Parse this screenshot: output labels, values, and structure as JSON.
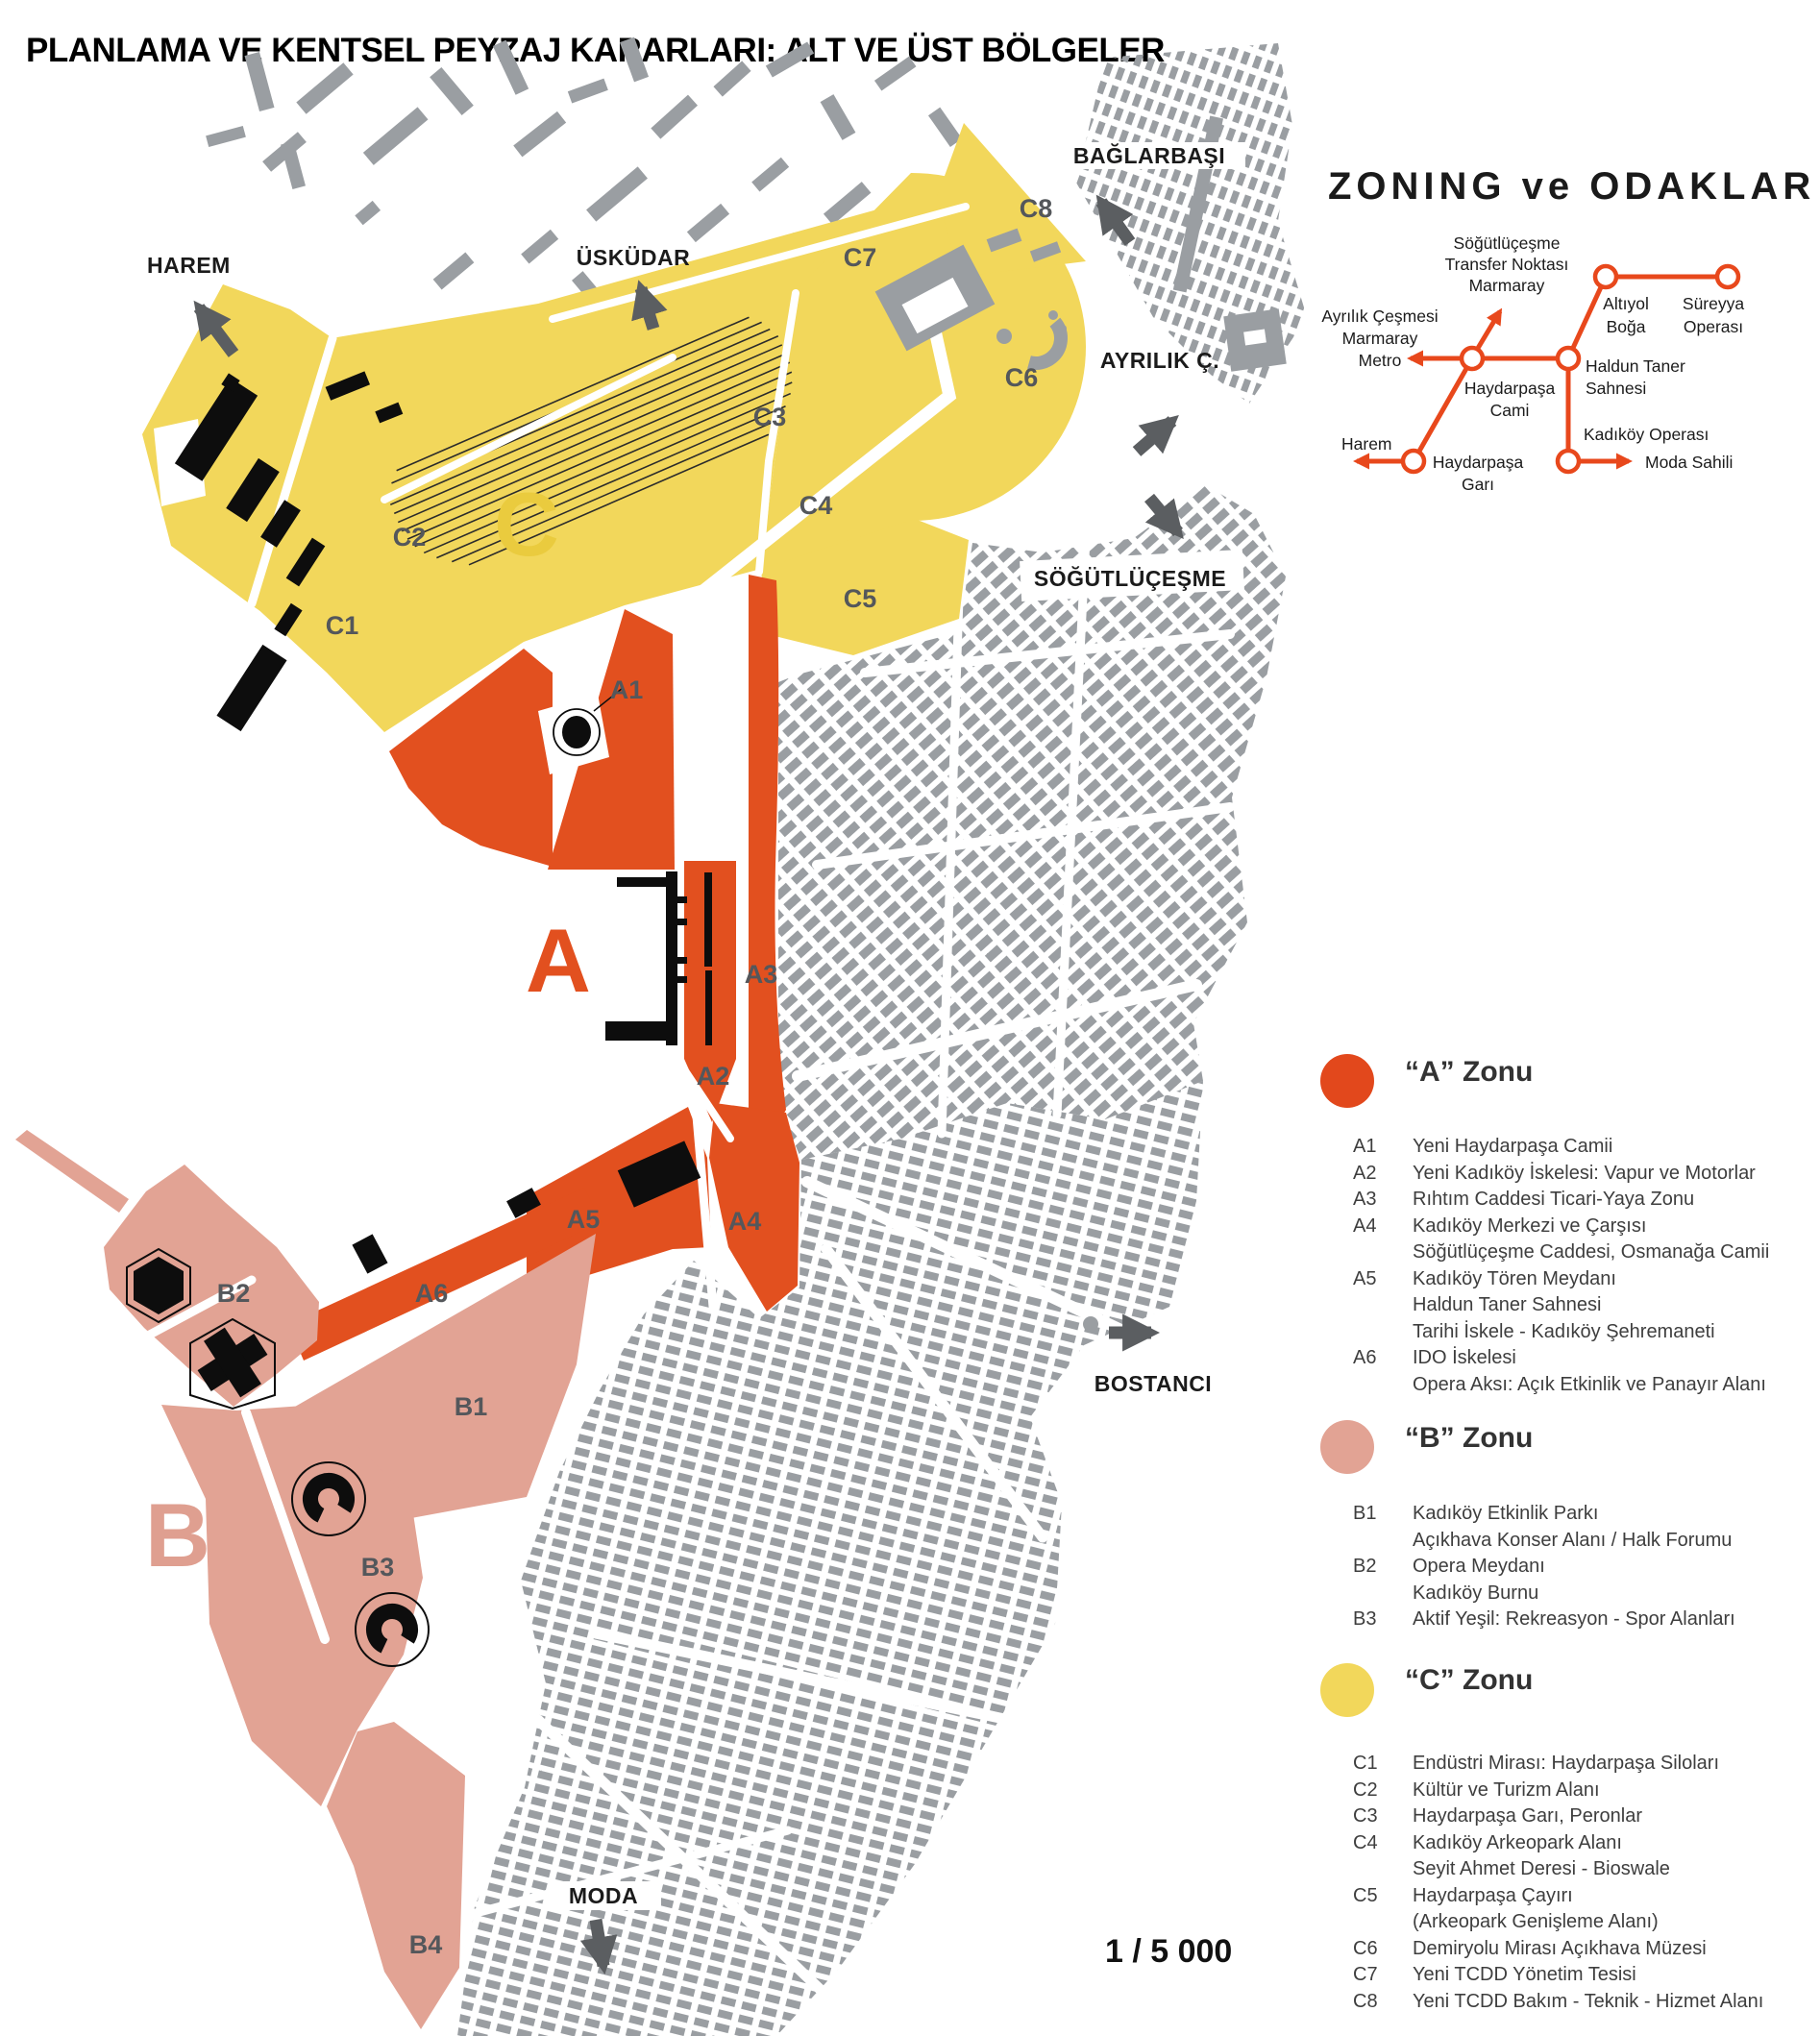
{
  "title": "PLANLAMA VE KENTSEL PEYZAJ KARARLARI: ALT VE ÜST BÖLGELER",
  "map": {
    "scale_label": "1 / 5 000",
    "places": {
      "harem": "HAREM",
      "uskudar": "ÜSKÜDAR",
      "baglarbasi": "BAĞLARBAŞI",
      "ayrilik": "AYRILIK Ç.",
      "sogutlucesme": "SÖĞÜTLÜÇEŞME",
      "bostanci": "BOSTANCI",
      "moda": "MODA"
    },
    "zone_letters": {
      "a": "A",
      "b": "B",
      "c": "C"
    },
    "codes": {
      "a1": "A1",
      "a2": "A2",
      "a3": "A3",
      "a4": "A4",
      "a5": "A5",
      "a6": "A6",
      "b1": "B1",
      "b2": "B2",
      "b3": "B3",
      "b4": "B4",
      "c1": "C1",
      "c2": "C2",
      "c3": "C3",
      "c4": "C4",
      "c5": "C5",
      "c6": "C6",
      "c7": "C7",
      "c8": "C8"
    },
    "colors": {
      "zone_a": "#e2501f",
      "zone_b": "#e2a394",
      "zone_c": "#f2d75b",
      "fabric_gray": "#9a9ea2",
      "arrow_gray": "#5b5e61",
      "building_black": "#0d0d0d"
    }
  },
  "panel": {
    "title": "ZONING ve ODAKLAR",
    "network": {
      "color": "#e8481c",
      "labels": {
        "sogutlucesme": [
          "Söğütlüçeşme",
          "Transfer Noktası",
          "Marmaray"
        ],
        "altiyol": [
          "Altıyol",
          "Boğa"
        ],
        "sureyya": [
          "Süreyya",
          "Operası"
        ],
        "ayrilik": [
          "Ayrılık Çeşmesi",
          "Marmaray",
          "Metro"
        ],
        "haydarpasa_cami": [
          "Haydarpaşa",
          "Cami"
        ],
        "haldun_taner": [
          "Haldun Taner",
          "Sahnesi"
        ],
        "harem": [
          "Harem"
        ],
        "haydarpasa_gar": [
          "Haydarpaşa",
          "Garı"
        ],
        "kadikoy_operasi": [
          "Kadıköy Operası"
        ],
        "moda_sahili": [
          "Moda Sahili"
        ]
      }
    },
    "legends": [
      {
        "key": "a",
        "title": "“A” Zonu",
        "color": "#e2481c",
        "items": [
          {
            "code": "A1",
            "lines": [
              "Yeni Haydarpaşa Camii"
            ]
          },
          {
            "code": "A2",
            "lines": [
              "Yeni Kadıköy İskelesi: Vapur ve Motorlar"
            ]
          },
          {
            "code": "A3",
            "lines": [
              "Rıhtım Caddesi Ticari-Yaya Zonu"
            ]
          },
          {
            "code": "A4",
            "lines": [
              "Kadıköy Merkezi ve Çarşısı",
              "Söğütlüçeşme Caddesi, Osmanağa Camii"
            ]
          },
          {
            "code": "A5",
            "lines": [
              "Kadıköy Tören Meydanı",
              "Haldun Taner Sahnesi",
              "Tarihi İskele - Kadıköy Şehremaneti"
            ]
          },
          {
            "code": "A6",
            "lines": [
              "IDO İskelesi",
              "Opera Aksı: Açık Etkinlik ve Panayır Alanı"
            ]
          }
        ]
      },
      {
        "key": "b",
        "title": "“B” Zonu",
        "color": "#e2a394",
        "items": [
          {
            "code": "B1",
            "lines": [
              "Kadıköy Etkinlik Parkı",
              "Açıkhava Konser Alanı / Halk Forumu"
            ]
          },
          {
            "code": "B2",
            "lines": [
              "Opera Meydanı",
              "Kadıköy Burnu"
            ]
          },
          {
            "code": "B3",
            "lines": [
              "Aktif Yeşil: Rekreasyon - Spor Alanları"
            ]
          }
        ]
      },
      {
        "key": "c",
        "title": "“C” Zonu",
        "color": "#f2d75b",
        "items": [
          {
            "code": "C1",
            "lines": [
              "Endüstri Mirası: Haydarpaşa Siloları"
            ]
          },
          {
            "code": "C2",
            "lines": [
              "Kültür ve Turizm Alanı"
            ]
          },
          {
            "code": "C3",
            "lines": [
              "Haydarpaşa Garı, Peronlar"
            ]
          },
          {
            "code": "C4",
            "lines": [
              "Kadıköy Arkeopark Alanı",
              "Seyit Ahmet Deresi - Bioswale"
            ]
          },
          {
            "code": "C5",
            "lines": [
              "Haydarpaşa Çayırı",
              "(Arkeopark Genişleme Alanı)"
            ]
          },
          {
            "code": "C6",
            "lines": [
              "Demiryolu Mirası Açıkhava Müzesi"
            ]
          },
          {
            "code": "C7",
            "lines": [
              "Yeni TCDD  Yönetim Tesisi"
            ]
          },
          {
            "code": "C8",
            "lines": [
              "Yeni TCDD  Bakım - Teknik - Hizmet Alanı"
            ]
          }
        ]
      }
    ]
  }
}
